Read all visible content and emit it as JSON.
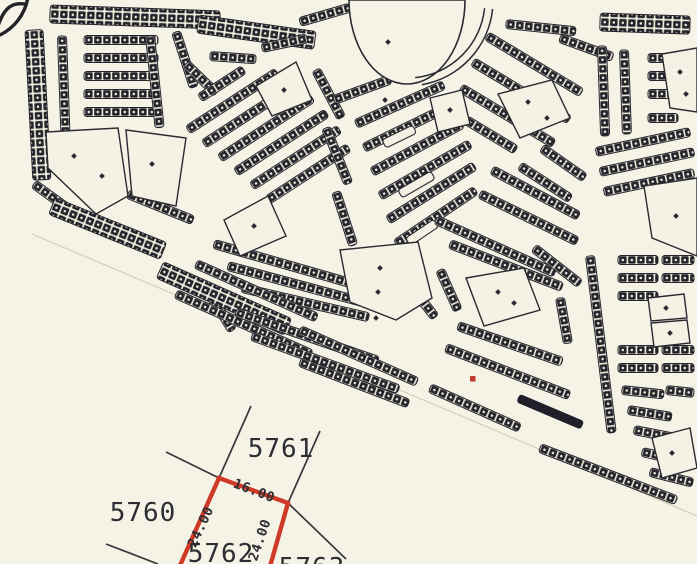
{
  "colors": {
    "paper": "#f5f3e6",
    "ink": "#2b2a31",
    "parcel_red": "#cf3a27",
    "marker_red": "#c23b2c"
  },
  "cadastral": {
    "north_parcel_label": "5761",
    "west_parcel_label": "5760",
    "selected_parcel_label": "5762",
    "southeast_parcel_label_partial": "5763",
    "dimensions": {
      "top": "16.00",
      "left": "24.00",
      "right": "24.00"
    }
  }
}
